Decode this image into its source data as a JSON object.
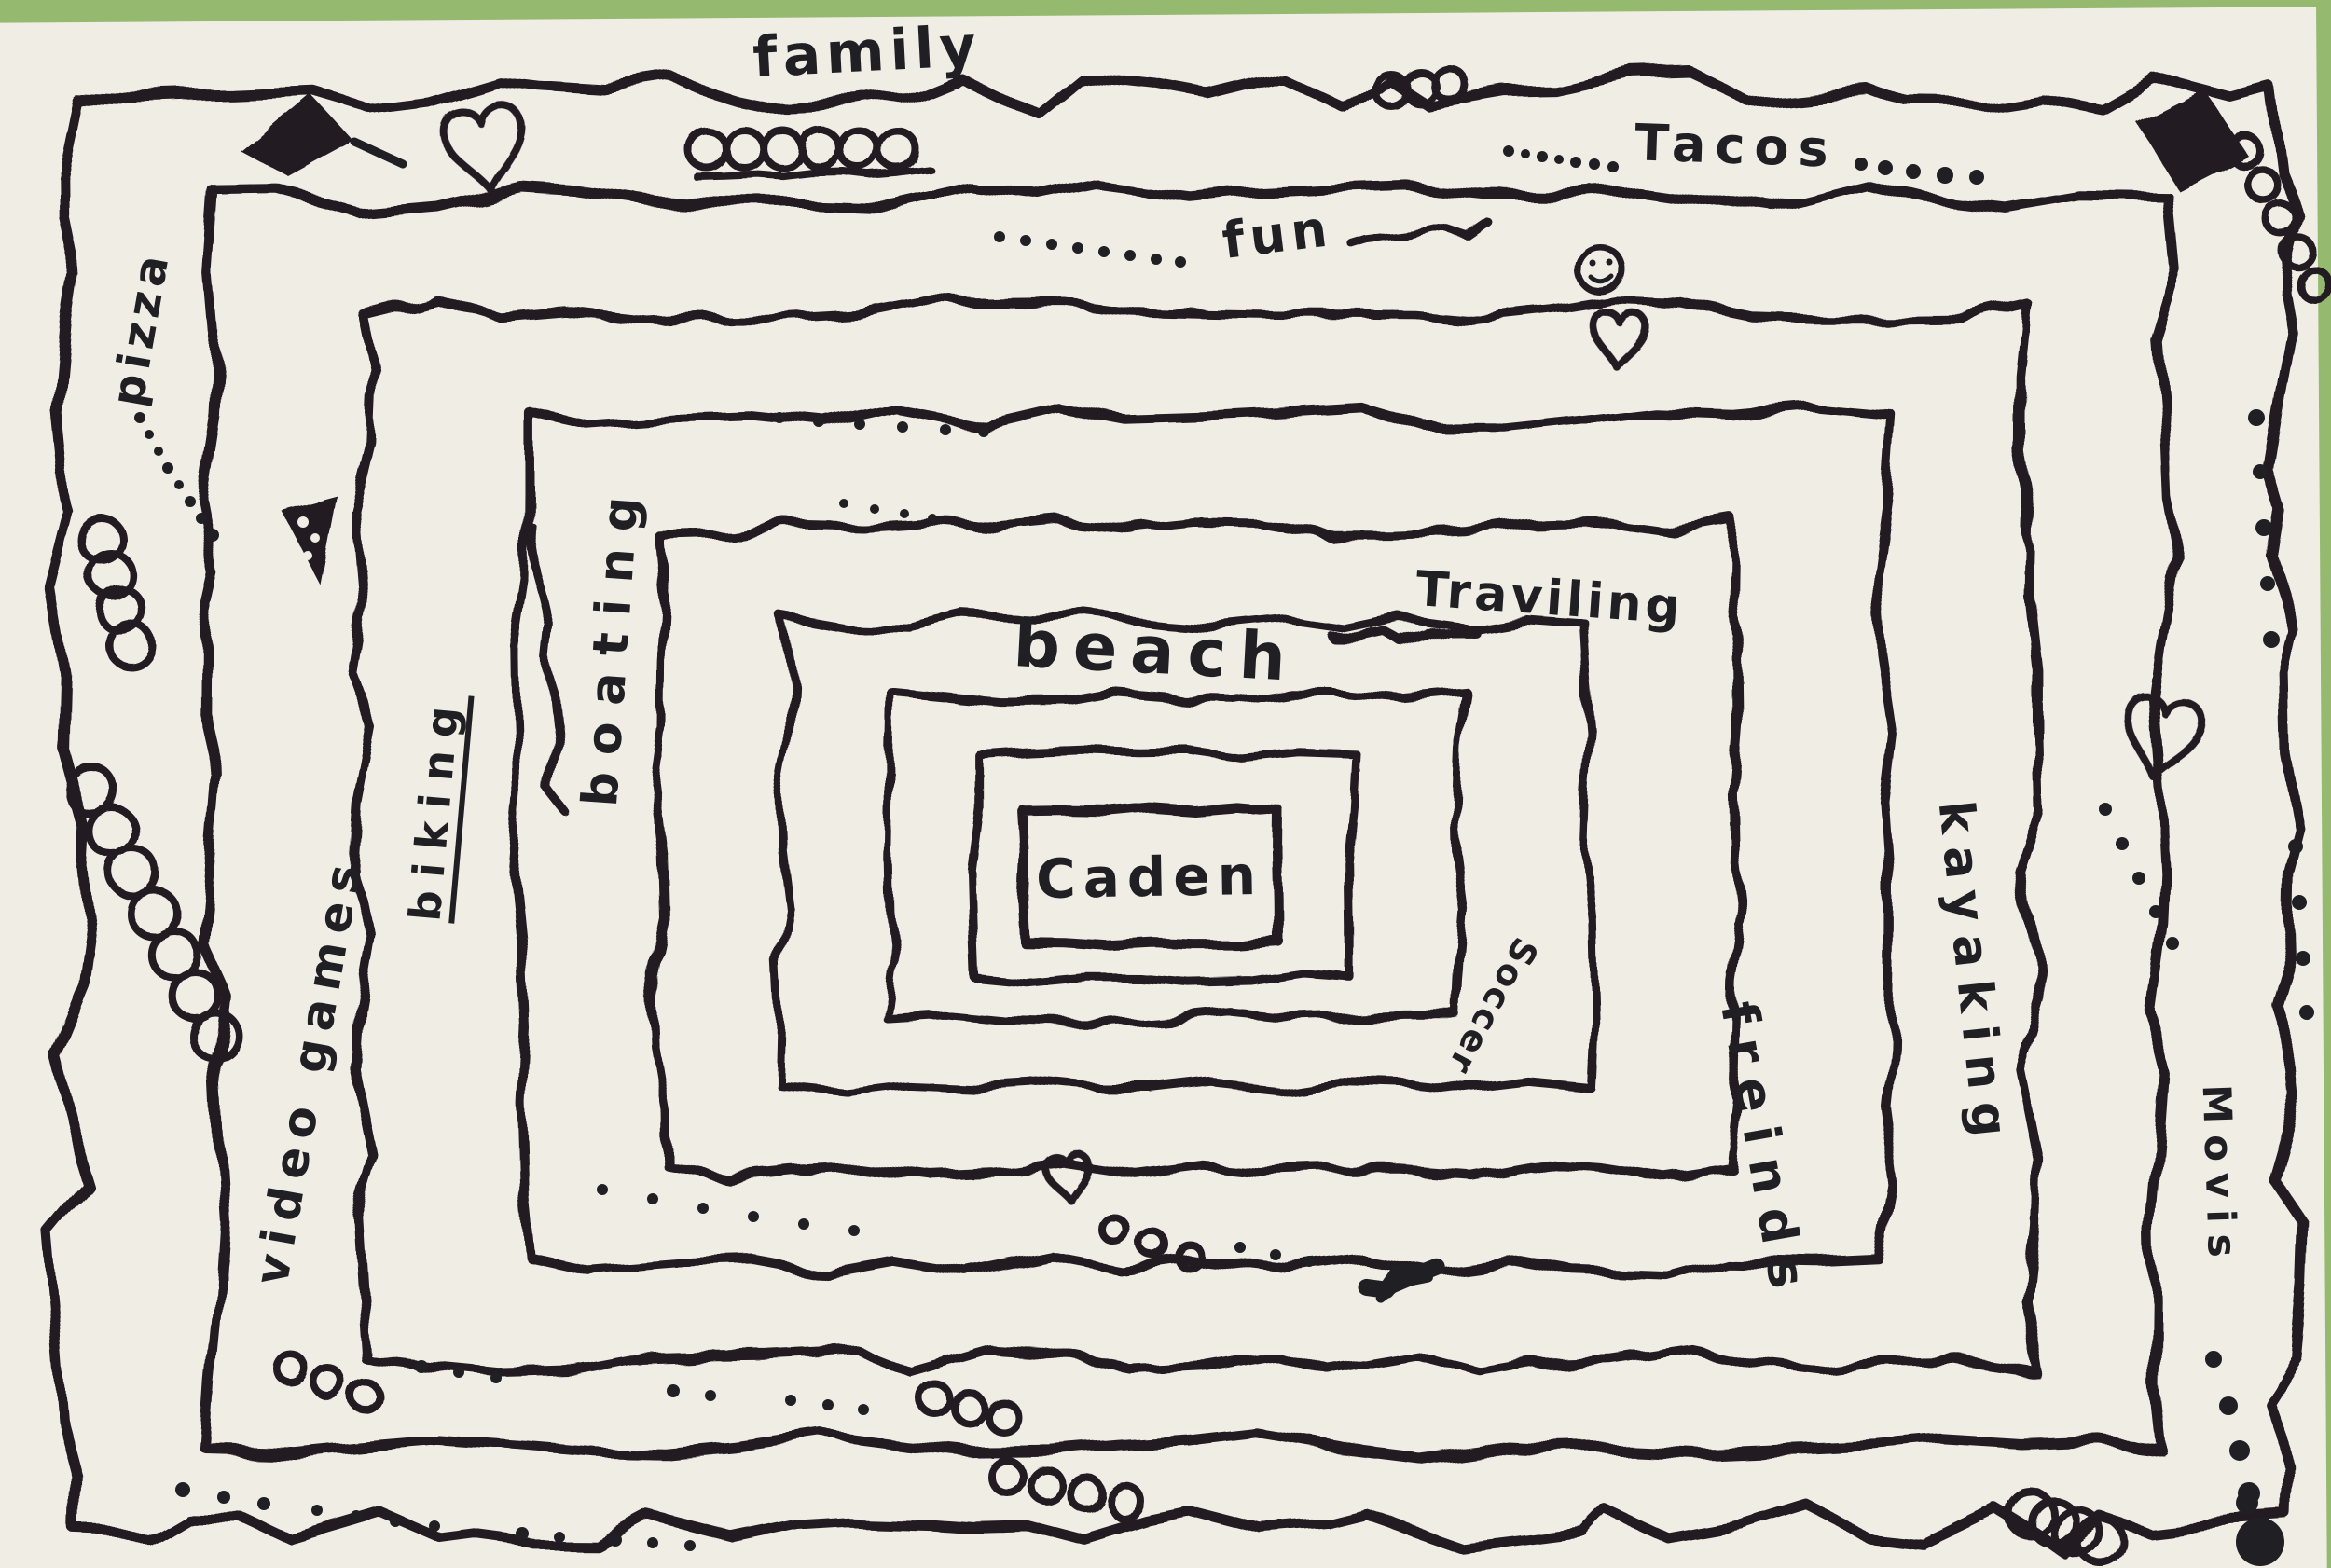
{
  "scene": {
    "background_color": "#94b96f",
    "paper_color": "#f0ede5",
    "ink_color": "#201f23"
  },
  "labels": {
    "family": {
      "text": "family"
    },
    "tacos": {
      "text": "Tacos"
    },
    "fun": {
      "text": "fun"
    },
    "traveling": {
      "text": "Traviling"
    },
    "beach": {
      "text": "beach"
    },
    "caden": {
      "text": "Caden"
    },
    "soccer": {
      "text": "Soccer"
    },
    "boating": {
      "text": "boating"
    },
    "biking": {
      "text": "biking"
    },
    "video_games": {
      "text": "video games"
    },
    "pizza": {
      "text": "pizza"
    },
    "kayaking": {
      "text": "kayaking"
    },
    "friends": {
      "text": "freinds"
    },
    "movies": {
      "text": "Movis"
    }
  },
  "icons": [
    "heart-icon",
    "smiley-face-icon",
    "pizza-slice-icon",
    "flag-icon",
    "triangle-blob-icon",
    "spiral-doodle-icon",
    "loop-doodle",
    "dot-trail"
  ]
}
